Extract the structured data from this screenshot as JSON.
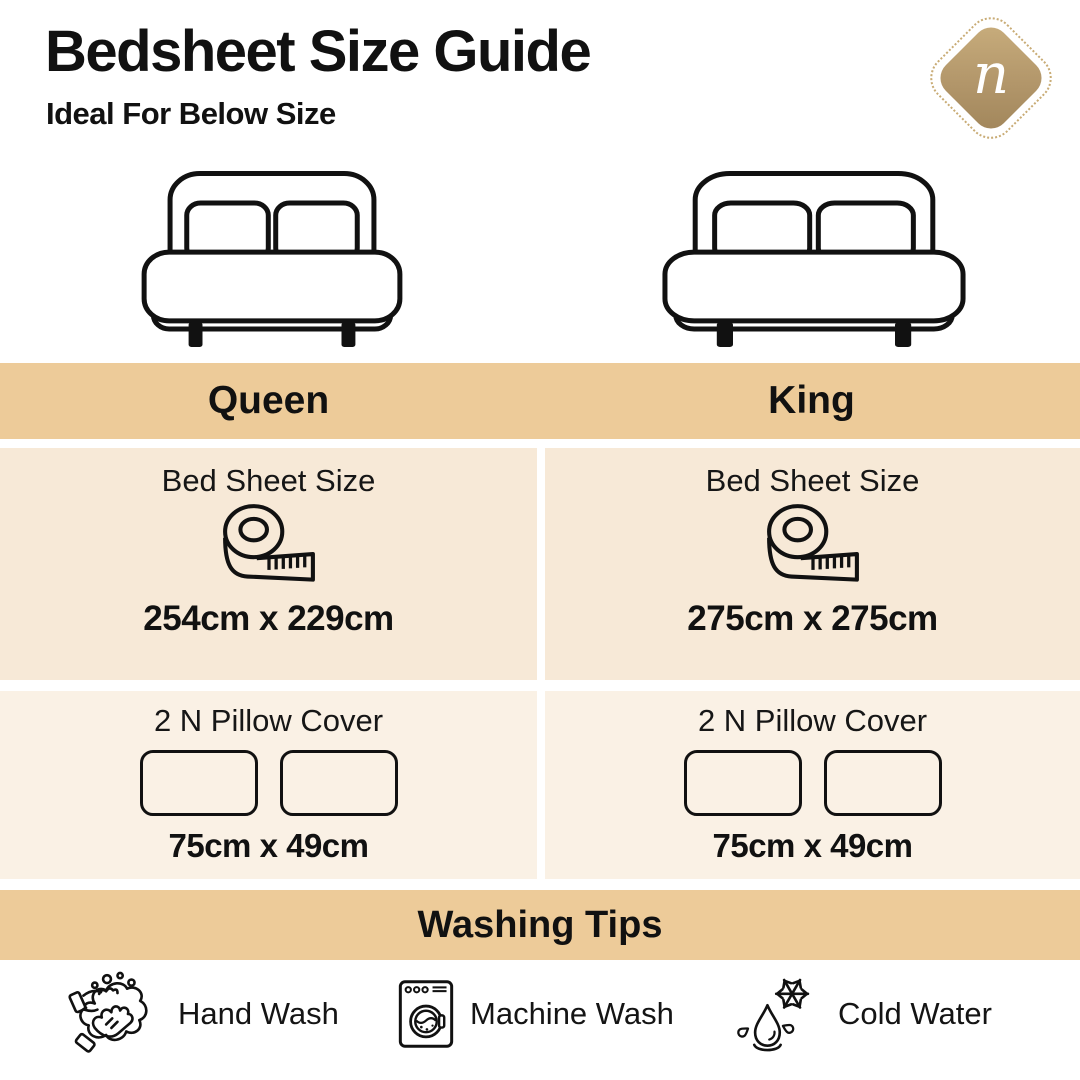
{
  "header": {
    "title": "Bedsheet Size Guide",
    "subtitle": "Ideal For Below Size",
    "logo_letter": "n"
  },
  "colors": {
    "band": "#edcb99",
    "cell_row1": "#f7e9d7",
    "cell_row2": "#faf1e5",
    "logo_gold": "#b2966a",
    "text": "#111111"
  },
  "columns": [
    {
      "name": "Queen",
      "bed_icon": "double-bed-icon",
      "sheet_label": "Bed Sheet Size",
      "sheet_icon": "measuring-tape-icon",
      "sheet_size": "254cm x 229cm",
      "pillow_label": "2 N Pillow Cover",
      "pillow_size": "75cm x 49cm"
    },
    {
      "name": "King",
      "bed_icon": "double-bed-icon",
      "sheet_label": "Bed Sheet Size",
      "sheet_icon": "measuring-tape-icon",
      "sheet_size": "275cm x 275cm",
      "pillow_label": "2 N Pillow Cover",
      "pillow_size": "75cm x 49cm"
    }
  ],
  "washing": {
    "title": "Washing Tips",
    "tips": [
      {
        "icon": "hand-wash-icon",
        "label": "Hand Wash"
      },
      {
        "icon": "machine-wash-icon",
        "label": "Machine Wash"
      },
      {
        "icon": "cold-water-icon",
        "label": "Cold Water"
      }
    ]
  }
}
